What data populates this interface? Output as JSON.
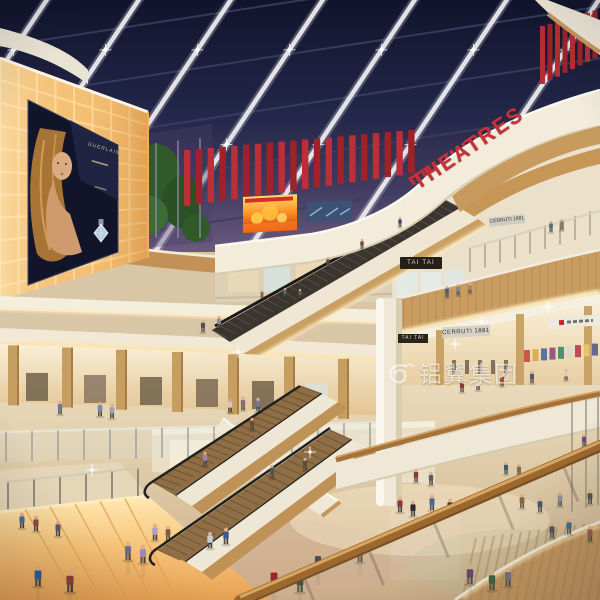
{
  "signs": {
    "theatres": "THEATRES",
    "tai_tai_upper": "TAI TAI",
    "tai_tai_lower": "TAI TAI",
    "cerruti_upper": "CERRUTI 1881",
    "cerruti_lower": "CERRUTI 1881",
    "poster_brand": "GUERLAIN"
  },
  "watermark": {
    "text": "铝翼集团"
  },
  "colors": {
    "ceiling_navy": "#10142c",
    "accent_red": "#b1282e",
    "warm_wall_glow": "#f7c87e",
    "fascia_cream": "#f3ecda",
    "wood": "#c89a5f",
    "floor_beige": "#dcc6a2"
  }
}
